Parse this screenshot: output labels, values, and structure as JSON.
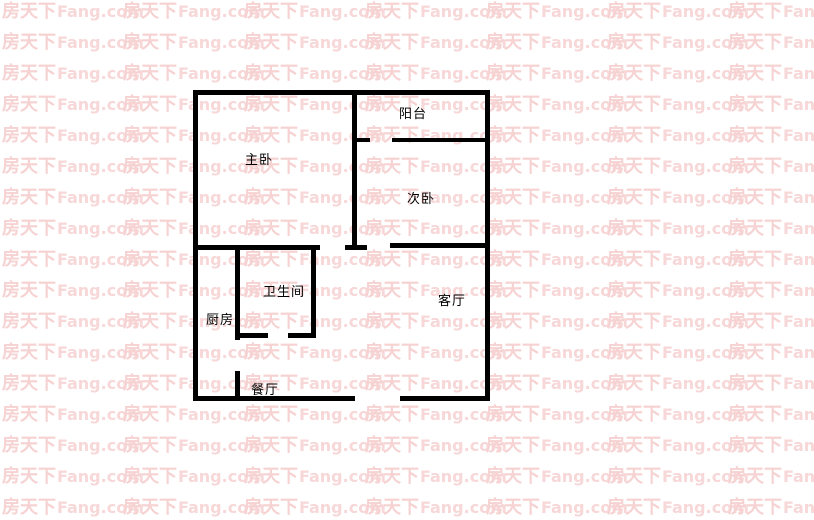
{
  "watermark": {
    "brand_cjk": "房天下",
    "brand_latin": "Fang.com",
    "color_cjk": "#f6d2d2",
    "color_latin": "#f7d7d7",
    "rows": 17,
    "units_per_row": 7
  },
  "floorplan": {
    "wall_color": "#000000",
    "rooms": [
      {
        "id": "master-bedroom",
        "label": "主卧"
      },
      {
        "id": "balcony",
        "label": "阳台"
      },
      {
        "id": "second-bedroom",
        "label": "次卧"
      },
      {
        "id": "bathroom",
        "label": "卫生间"
      },
      {
        "id": "kitchen",
        "label": "厨房"
      },
      {
        "id": "living-room",
        "label": "客厅"
      },
      {
        "id": "dining-room",
        "label": "餐厅"
      }
    ]
  }
}
